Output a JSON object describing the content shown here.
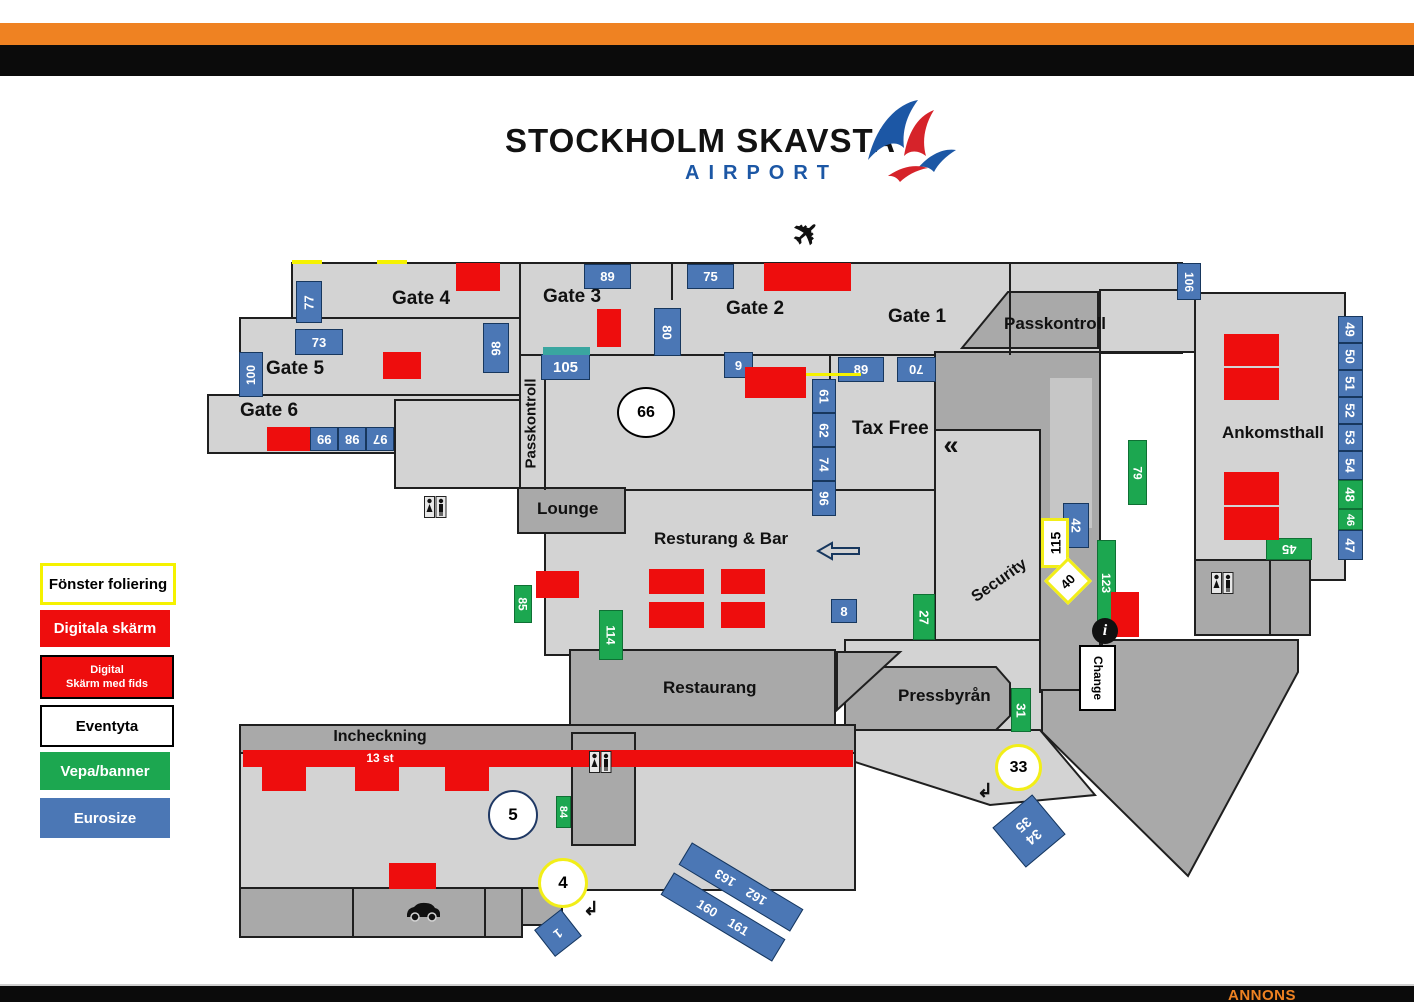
{
  "logo": {
    "title": "STOCKHOLM SKAVSTA",
    "subtitle": "AIRPORT"
  },
  "footer": {
    "annons": "ANNONS"
  },
  "legend": {
    "items": [
      {
        "label": "Fönster foliering",
        "type": "fonster"
      },
      {
        "label": "Digitala skärm",
        "type": "digitala-skarm"
      },
      {
        "label": "Digital",
        "label2": "Skärm med fids",
        "type": "digital-skarm-med-fids"
      },
      {
        "label": "Eventyta",
        "type": "eventyta"
      },
      {
        "label": "Vepa/banner",
        "type": "vepa-banner"
      },
      {
        "label": "Eurosize",
        "type": "eurosize"
      }
    ]
  },
  "colors": {
    "orange": "#ef8222",
    "black": "#0b0b0b",
    "red": "#ee0d0d",
    "green": "#1ca750",
    "blue": "#4b77b5",
    "yellow": "#f5f200",
    "floor_light": "#d3d3d3",
    "floor_dark": "#a9a9a9"
  },
  "areas": {
    "gate4": "Gate 4",
    "gate3": "Gate 3",
    "gate2": "Gate 2",
    "gate1": "Gate 1",
    "gate5": "Gate 5",
    "gate6": "Gate 6",
    "passkontroll_corridor": "Passkontroll",
    "passkontroll_room": "Passkontroll",
    "taxfree": "Tax Free",
    "ankomsthall": "Ankomsthall",
    "lounge": "Lounge",
    "resturang_bar": "Resturang & Bar",
    "restaurang": "Restaurang",
    "pressbyran": "Pressbyrån",
    "security": "Security",
    "incheckning": "Incheckning",
    "checkin_count": "13 st"
  },
  "icons": [
    "airplane-icon",
    "restroom-icon",
    "car-icon",
    "info-icon",
    "left-arrow-icon",
    "chevron-left-icon",
    "turn-arrow-icon"
  ],
  "markers": [
    {
      "l": "77",
      "t": "eurosize",
      "x": 296,
      "y": 281,
      "w": 26,
      "h": 42,
      "tr": -90
    },
    {
      "l": "73",
      "t": "eurosize",
      "x": 295,
      "y": 329,
      "w": 48,
      "h": 26
    },
    {
      "l": "100",
      "t": "eurosize",
      "x": 239,
      "y": 352,
      "w": 24,
      "h": 45,
      "tr": -90,
      "fs": 12
    },
    {
      "l": "99",
      "t": "eurosize",
      "x": 310,
      "y": 427,
      "w": 28,
      "h": 24,
      "tr": 180
    },
    {
      "l": "98",
      "t": "eurosize",
      "x": 338,
      "y": 427,
      "w": 28,
      "h": 24,
      "tr": 180
    },
    {
      "l": "97",
      "t": "eurosize",
      "x": 366,
      "y": 427,
      "w": 28,
      "h": 24,
      "tr": 180
    },
    {
      "l": "89",
      "t": "eurosize",
      "x": 584,
      "y": 264,
      "w": 47,
      "h": 25
    },
    {
      "l": "75",
      "t": "eurosize",
      "x": 687,
      "y": 264,
      "w": 47,
      "h": 25
    },
    {
      "l": "80",
      "t": "eurosize",
      "x": 654,
      "y": 308,
      "w": 27,
      "h": 48,
      "tr": 90
    },
    {
      "l": "98",
      "t": "eurosize",
      "x": 483,
      "y": 323,
      "w": 26,
      "h": 50,
      "tr": -90
    },
    {
      "l": "105",
      "t": "eurosize",
      "x": 541,
      "y": 354,
      "w": 49,
      "h": 26,
      "fs": 15
    },
    {
      "l": "9",
      "t": "eurosize",
      "x": 724,
      "y": 352,
      "w": 29,
      "h": 26
    },
    {
      "l": "61",
      "t": "eurosize",
      "x": 812,
      "y": 379,
      "w": 24,
      "h": 34,
      "tr": 90
    },
    {
      "l": "62",
      "t": "eurosize",
      "x": 812,
      "y": 413,
      "w": 24,
      "h": 34,
      "tr": 90
    },
    {
      "l": "74",
      "t": "eurosize",
      "x": 812,
      "y": 447,
      "w": 24,
      "h": 34,
      "tr": 90
    },
    {
      "l": "96",
      "t": "eurosize",
      "x": 812,
      "y": 481,
      "w": 24,
      "h": 35,
      "tr": 90
    },
    {
      "l": "89",
      "t": "eurosize",
      "x": 838,
      "y": 357,
      "w": 46,
      "h": 25
    },
    {
      "l": "70",
      "t": "eurosize",
      "x": 897,
      "y": 357,
      "w": 39,
      "h": 25,
      "tr": 180
    },
    {
      "l": "106",
      "t": "eurosize",
      "x": 1177,
      "y": 263,
      "w": 24,
      "h": 37,
      "tr": 90,
      "fs": 12
    },
    {
      "l": "49",
      "t": "eurosize",
      "x": 1338,
      "y": 316,
      "w": 25,
      "h": 27,
      "tr": 90
    },
    {
      "l": "50",
      "t": "eurosize",
      "x": 1338,
      "y": 343,
      "w": 25,
      "h": 27,
      "tr": 90
    },
    {
      "l": "51",
      "t": "eurosize",
      "x": 1338,
      "y": 370,
      "w": 25,
      "h": 27,
      "tr": 90
    },
    {
      "l": "52",
      "t": "eurosize",
      "x": 1338,
      "y": 397,
      "w": 25,
      "h": 27,
      "tr": 90
    },
    {
      "l": "53",
      "t": "eurosize",
      "x": 1338,
      "y": 424,
      "w": 25,
      "h": 27,
      "tr": 90
    },
    {
      "l": "54",
      "t": "eurosize",
      "x": 1338,
      "y": 451,
      "w": 25,
      "h": 29,
      "tr": 90
    },
    {
      "l": "48",
      "t": "vepa",
      "x": 1338,
      "y": 480,
      "w": 25,
      "h": 29,
      "tr": 90
    },
    {
      "l": "46",
      "t": "vepa",
      "x": 1338,
      "y": 509,
      "w": 25,
      "h": 21,
      "tr": 90,
      "fs": 11
    },
    {
      "l": "47",
      "t": "eurosize",
      "x": 1338,
      "y": 530,
      "w": 25,
      "h": 30,
      "tr": 90
    },
    {
      "l": "45",
      "t": "vepa",
      "x": 1266,
      "y": 538,
      "w": 46,
      "h": 22,
      "tr": 180
    },
    {
      "l": "8",
      "t": "eurosize",
      "x": 831,
      "y": 599,
      "w": 26,
      "h": 24
    },
    {
      "l": "42",
      "t": "eurosize",
      "x": 1063,
      "y": 503,
      "w": 26,
      "h": 45,
      "tr": 90
    },
    {
      "l": "34\n35",
      "t": "eurosize",
      "x": 1003,
      "y": 805,
      "w": 52,
      "h": 52,
      "r": -40,
      "tr": 180,
      "fs": 14
    },
    {
      "l": "1",
      "t": "eurosize",
      "x": 541,
      "y": 916,
      "w": 34,
      "h": 34,
      "r": -38,
      "tr": 180
    },
    {
      "l": "160    161",
      "t": "eurosize",
      "x": 658,
      "y": 904,
      "w": 130,
      "h": 26,
      "r": 31
    },
    {
      "l": "162    163",
      "t": "eurosize",
      "x": 676,
      "y": 874,
      "w": 130,
      "h": 26,
      "r": 31,
      "tr": 180
    },
    {
      "l": "79",
      "t": "vepa",
      "x": 1128,
      "y": 440,
      "w": 19,
      "h": 65,
      "tr": 90,
      "fs": 12
    },
    {
      "l": "123",
      "t": "vepa",
      "x": 1097,
      "y": 540,
      "w": 19,
      "h": 85,
      "tr": 90,
      "fs": 12
    },
    {
      "l": "27",
      "t": "vepa",
      "x": 913,
      "y": 594,
      "w": 22,
      "h": 46,
      "tr": 90
    },
    {
      "l": "85",
      "t": "vepa",
      "x": 514,
      "y": 585,
      "w": 18,
      "h": 38,
      "tr": 90,
      "fs": 12
    },
    {
      "l": "114",
      "t": "vepa",
      "x": 599,
      "y": 610,
      "w": 24,
      "h": 50,
      "tr": 90,
      "fs": 12
    },
    {
      "l": "31",
      "t": "vepa",
      "x": 1011,
      "y": 688,
      "w": 20,
      "h": 44,
      "tr": 90
    },
    {
      "l": "84",
      "t": "vepa",
      "x": 556,
      "y": 796,
      "w": 15,
      "h": 32,
      "tr": 90,
      "fs": 11
    },
    {
      "t": "teal",
      "x": 543,
      "y": 347,
      "w": 47,
      "h": 8
    },
    {
      "t": "digital",
      "x": 456,
      "y": 263,
      "w": 44,
      "h": 28
    },
    {
      "t": "digital",
      "x": 383,
      "y": 352,
      "w": 38,
      "h": 27
    },
    {
      "t": "digital",
      "x": 597,
      "y": 309,
      "w": 24,
      "h": 38
    },
    {
      "t": "digital",
      "x": 764,
      "y": 263,
      "w": 87,
      "h": 28
    },
    {
      "t": "digital",
      "x": 745,
      "y": 367,
      "w": 61,
      "h": 31
    },
    {
      "t": "digital",
      "x": 267,
      "y": 427,
      "w": 43,
      "h": 24
    },
    {
      "t": "digital",
      "x": 1224,
      "y": 334,
      "w": 55,
      "h": 32
    },
    {
      "t": "digital",
      "x": 1224,
      "y": 368,
      "w": 55,
      "h": 32
    },
    {
      "t": "digital",
      "x": 1224,
      "y": 472,
      "w": 55,
      "h": 33
    },
    {
      "t": "digital",
      "x": 1224,
      "y": 507,
      "w": 55,
      "h": 33
    },
    {
      "t": "digital",
      "x": 536,
      "y": 571,
      "w": 43,
      "h": 27
    },
    {
      "t": "digital",
      "x": 649,
      "y": 569,
      "w": 55,
      "h": 25
    },
    {
      "t": "digital",
      "x": 721,
      "y": 569,
      "w": 44,
      "h": 25
    },
    {
      "t": "digital",
      "x": 649,
      "y": 602,
      "w": 55,
      "h": 26
    },
    {
      "t": "digital",
      "x": 721,
      "y": 602,
      "w": 44,
      "h": 26
    },
    {
      "t": "digital",
      "x": 1111,
      "y": 592,
      "w": 28,
      "h": 45
    },
    {
      "t": "digital",
      "x": 243,
      "y": 750,
      "w": 610,
      "h": 17
    },
    {
      "t": "digital",
      "x": 262,
      "y": 767,
      "w": 44,
      "h": 24
    },
    {
      "t": "digital",
      "x": 355,
      "y": 767,
      "w": 44,
      "h": 24
    },
    {
      "t": "digital",
      "x": 445,
      "y": 767,
      "w": 44,
      "h": 24
    },
    {
      "t": "digital",
      "x": 389,
      "y": 863,
      "w": 47,
      "h": 26
    },
    {
      "t": "yline",
      "x": 806,
      "y": 373,
      "w": 55,
      "h": 3
    },
    {
      "t": "yline",
      "x": 292,
      "y": 260,
      "w": 30,
      "h": 4
    },
    {
      "t": "yline",
      "x": 377,
      "y": 260,
      "w": 30,
      "h": 4
    },
    {
      "l": "115",
      "t": "fonster",
      "x": 1041,
      "y": 518,
      "w": 28,
      "h": 50,
      "tr": -90,
      "fs": 14
    },
    {
      "l": "40",
      "t": "fonster",
      "x": 1051,
      "y": 564,
      "w": 34,
      "h": 34,
      "r": 45,
      "tr": -90
    },
    {
      "l": "4",
      "t": "fonster",
      "x": 538,
      "y": 858,
      "w": 50,
      "h": 50,
      "sh": "circle",
      "fs": 17
    },
    {
      "l": "33",
      "t": "fonster",
      "x": 995,
      "y": 744,
      "w": 47,
      "h": 47,
      "sh": "circle",
      "fs": 16
    },
    {
      "l": "66",
      "t": "eventyta",
      "x": 617,
      "y": 387,
      "w": 58,
      "h": 51,
      "sh": "circle",
      "fs": 16
    },
    {
      "l": "5",
      "t": "eventyta",
      "x": 488,
      "y": 790,
      "w": 50,
      "h": 50,
      "sh": "circle",
      "fs": 17,
      "bc": "#1f3864"
    },
    {
      "l": "Change",
      "t": "eventyta",
      "x": 1079,
      "y": 645,
      "w": 37,
      "h": 66,
      "tr": 90,
      "fs": 12
    },
    {
      "l": "i",
      "t": "info",
      "x": 1092,
      "y": 618,
      "w": 26,
      "h": 26,
      "sh": "circle",
      "fs": 16
    },
    {
      "l": "«",
      "t": "plain",
      "x": 936,
      "y": 430,
      "w": 30,
      "h": 30,
      "fs": 27
    },
    {
      "l": "✈",
      "t": "plain",
      "x": 784,
      "y": 212,
      "w": 44,
      "h": 42,
      "r": -42,
      "fs": 33
    },
    {
      "l": "↲",
      "t": "plain",
      "x": 974,
      "y": 780,
      "w": 22,
      "h": 22,
      "fs": 19
    },
    {
      "l": "↲",
      "t": "plain",
      "x": 580,
      "y": 898,
      "w": 22,
      "h": 22,
      "fs": 19
    },
    {
      "t": "wc",
      "x": 424,
      "y": 496,
      "w": 23,
      "h": 21
    },
    {
      "t": "wc",
      "x": 589,
      "y": 751,
      "w": 23,
      "h": 22
    },
    {
      "t": "wc",
      "x": 1211,
      "y": 572,
      "w": 23,
      "h": 22
    },
    {
      "t": "arrowl",
      "x": 816,
      "y": 540,
      "w": 44,
      "h": 22
    },
    {
      "t": "car",
      "x": 404,
      "y": 900,
      "w": 38,
      "h": 23
    }
  ]
}
